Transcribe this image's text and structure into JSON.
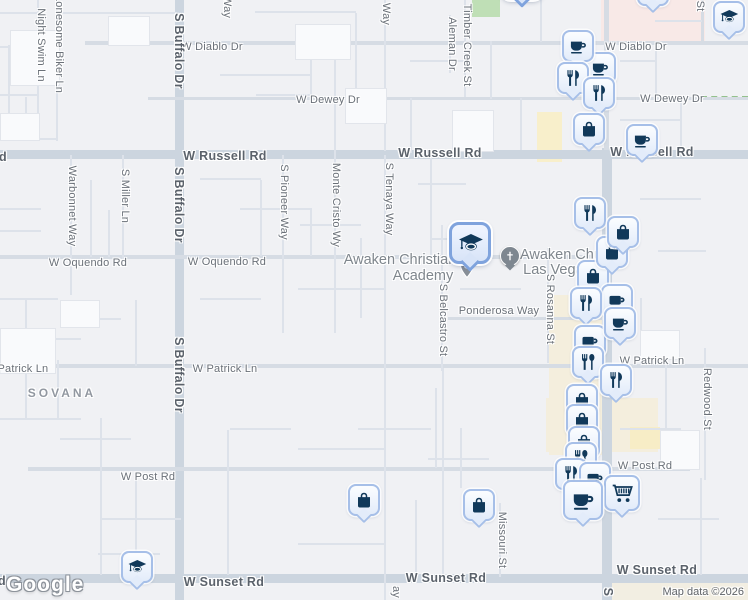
{
  "map": {
    "logo": "Google",
    "attribution": "Map data ©2026",
    "selected_place": "Awaken Christian Academy",
    "place_labels": [
      {
        "text": "Awaken Christian",
        "x": 400,
        "y": 260
      },
      {
        "text": "Academy",
        "x": 423,
        "y": 276
      },
      {
        "text": "Awaken Church",
        "x": 571,
        "y": 255
      },
      {
        "text": "Las Vegas",
        "x": 557,
        "y": 270
      }
    ],
    "neighborhood_labels": [
      {
        "text": "SOVANA",
        "x": 62,
        "y": 393
      }
    ],
    "street_labels": [
      {
        "t": "W Diablo Dr",
        "x": 212,
        "y": 47,
        "o": "h"
      },
      {
        "t": "W Diablo Dr",
        "x": 636,
        "y": 47,
        "o": "h"
      },
      {
        "t": "W Dewey Dr",
        "x": 328,
        "y": 100,
        "o": "h"
      },
      {
        "t": "W Dewey Dr",
        "x": 672,
        "y": 99,
        "o": "h"
      },
      {
        "t": "d",
        "x": 3,
        "y": 157,
        "o": "h",
        "c": "major"
      },
      {
        "t": "W Russell Rd",
        "x": 225,
        "y": 156,
        "o": "h",
        "c": "major"
      },
      {
        "t": "W Russell Rd",
        "x": 440,
        "y": 153,
        "o": "h",
        "c": "major"
      },
      {
        "t": "W Russell Rd",
        "x": 652,
        "y": 152,
        "o": "h",
        "c": "major"
      },
      {
        "t": "W Oquendo Rd",
        "x": 88,
        "y": 263,
        "o": "h"
      },
      {
        "t": "W Oquendo Rd",
        "x": 227,
        "y": 262,
        "o": "h"
      },
      {
        "t": "Ponderosa Way",
        "x": 499,
        "y": 311,
        "o": "h"
      },
      {
        "t": "W Patrick Ln",
        "x": 16,
        "y": 369,
        "o": "h"
      },
      {
        "t": "W Patrick Ln",
        "x": 225,
        "y": 369,
        "o": "h"
      },
      {
        "t": "W Patrick Ln",
        "x": 652,
        "y": 361,
        "o": "h"
      },
      {
        "t": "W Post Rd",
        "x": 148,
        "y": 477,
        "o": "h"
      },
      {
        "t": "W Post Rd",
        "x": 645,
        "y": 466,
        "o": "h"
      },
      {
        "t": "d",
        "x": 2,
        "y": 581,
        "o": "h",
        "c": "major"
      },
      {
        "t": "W Sunset Rd",
        "x": 224,
        "y": 582,
        "o": "h",
        "c": "major"
      },
      {
        "t": "W Sunset Rd",
        "x": 446,
        "y": 578,
        "o": "h",
        "c": "major"
      },
      {
        "t": "W Sunset Rd",
        "x": 657,
        "y": 570,
        "o": "h",
        "c": "major"
      },
      {
        "t": "Night Swim Ln",
        "x": 41,
        "y": 45,
        "o": "v"
      },
      {
        "t": "Lonesome Biker Ln",
        "x": 59,
        "y": 44,
        "o": "v"
      },
      {
        "t": "Way",
        "x": 227,
        "y": 7,
        "o": "v"
      },
      {
        "t": "S Buffalo Dr",
        "x": 179,
        "y": 51,
        "o": "v",
        "c": "major"
      },
      {
        "t": "S Buffalo Dr",
        "x": 179,
        "y": 205,
        "o": "v",
        "c": "major"
      },
      {
        "t": "S Buffalo Dr",
        "x": 179,
        "y": 375,
        "o": "v",
        "c": "major"
      },
      {
        "t": "Warbonnet Way",
        "x": 72,
        "y": 206,
        "o": "v"
      },
      {
        "t": "S Miller Ln",
        "x": 125,
        "y": 196,
        "o": "v"
      },
      {
        "t": "S Pioneer Way",
        "x": 284,
        "y": 202,
        "o": "v"
      },
      {
        "t": "Monte Cristo Wy",
        "x": 336,
        "y": 205,
        "o": "v"
      },
      {
        "t": "Way",
        "x": 386,
        "y": 14,
        "o": "v"
      },
      {
        "t": "S Tenaya Way",
        "x": 389,
        "y": 199,
        "o": "v"
      },
      {
        "t": "ay",
        "x": 396,
        "y": 592,
        "o": "v"
      },
      {
        "t": "Timber Creek St",
        "x": 467,
        "y": 45,
        "o": "v"
      },
      {
        "t": "Aleman Dr",
        "x": 452,
        "y": 44,
        "o": "v"
      },
      {
        "t": "S Belcastro St",
        "x": 443,
        "y": 320,
        "o": "v"
      },
      {
        "t": "S Rosanna St",
        "x": 550,
        "y": 309,
        "o": "v"
      },
      {
        "t": "Redwood St",
        "x": 707,
        "y": 399,
        "o": "v"
      },
      {
        "t": "Missouri St",
        "x": 502,
        "y": 540,
        "o": "v"
      },
      {
        "t": "St",
        "x": 700,
        "y": 6,
        "o": "v"
      },
      {
        "t": "S",
        "x": 608,
        "y": 592,
        "o": "v",
        "c": "major"
      }
    ],
    "pois": [
      {
        "type": "pin",
        "x": 467,
        "y": 268
      },
      {
        "type": "church",
        "x": 510,
        "y": 256
      }
    ],
    "markers": [
      {
        "icon": "coffee-cup",
        "x": 600,
        "y": 68
      },
      {
        "icon": "coffee-cup",
        "x": 578,
        "y": 46
      },
      {
        "icon": "restaurant",
        "x": 573,
        "y": 78
      },
      {
        "icon": "restaurant",
        "x": 599,
        "y": 93
      },
      {
        "icon": "shopping-bag",
        "x": 589,
        "y": 129
      },
      {
        "icon": "coffee-cup",
        "x": 642,
        "y": 140
      },
      {
        "icon": "graduation-cap",
        "x": 729,
        "y": 17
      },
      {
        "icon": "generic-circle",
        "x": 653,
        "y": -10
      },
      {
        "icon": "graduation-cap",
        "x": 522,
        "y": -21,
        "variant": "sel"
      },
      {
        "icon": "restaurant",
        "x": 590,
        "y": 213
      },
      {
        "icon": "shopping-bag",
        "x": 593,
        "y": 276
      },
      {
        "icon": "shopping-bag",
        "x": 612,
        "y": 252
      },
      {
        "icon": "shopping-bag",
        "x": 623,
        "y": 232
      },
      {
        "icon": "coffee-mug",
        "x": 617,
        "y": 300
      },
      {
        "icon": "restaurant",
        "x": 586,
        "y": 303
      },
      {
        "icon": "coffee-mug",
        "x": 590,
        "y": 341
      },
      {
        "icon": "coffee-cup",
        "x": 620,
        "y": 323
      },
      {
        "icon": "restaurant-spoon",
        "x": 588,
        "y": 362
      },
      {
        "icon": "restaurant",
        "x": 616,
        "y": 380
      },
      {
        "icon": "shopping-bag",
        "x": 582,
        "y": 400
      },
      {
        "icon": "shopping-bag",
        "x": 582,
        "y": 420
      },
      {
        "icon": "shopping-bag",
        "x": 584,
        "y": 442
      },
      {
        "icon": "restaurant-spoon",
        "x": 581,
        "y": 458
      },
      {
        "icon": "restaurant",
        "x": 571,
        "y": 474
      },
      {
        "icon": "coffee-mug",
        "x": 595,
        "y": 478
      },
      {
        "icon": "shopping-cart",
        "x": 622,
        "y": 493,
        "variant": "mid"
      },
      {
        "icon": "coffee-cup",
        "x": 583,
        "y": 500,
        "variant": "lg"
      },
      {
        "icon": "shopping-bag",
        "x": 364,
        "y": 500
      },
      {
        "icon": "shopping-bag",
        "x": 479,
        "y": 505
      },
      {
        "icon": "graduation-cap",
        "x": 137,
        "y": 567
      },
      {
        "icon": "graduation-cap",
        "x": 470,
        "y": 243,
        "variant": "sel"
      }
    ],
    "colors": {
      "land": "#f0f1f4",
      "road_major": "#ccd5df",
      "commercial_beige": "#f4eedd",
      "commercial_yellow": "#f8efcb",
      "residential_pink": "#f8e9e7",
      "park_green": "#bfdfb6",
      "marker_glyph": "#11395a",
      "marker_border": "#a6bfe8",
      "selected_border": "#7fa3dd"
    }
  }
}
